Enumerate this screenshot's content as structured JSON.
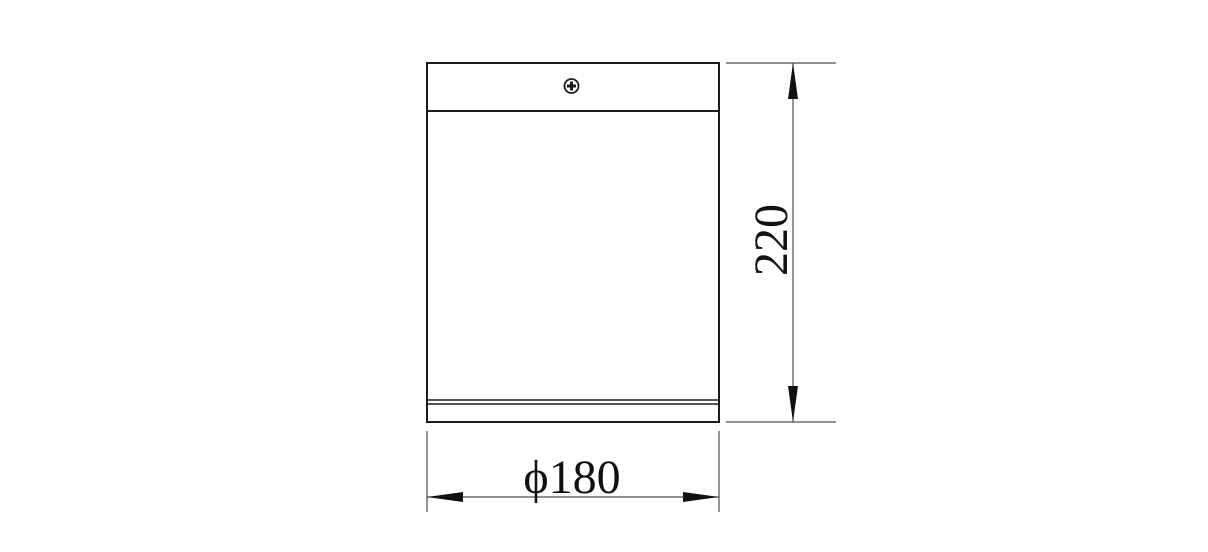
{
  "drawing": {
    "labels": {
      "diameter": "ϕ180",
      "height": "220"
    },
    "icons": {
      "screw": "phillips-screw-icon",
      "arrows": [
        "arrowhead-up-icon",
        "arrowhead-down-icon",
        "arrowhead-left-icon",
        "arrowhead-right-icon"
      ]
    },
    "colors": {
      "outline": "#1c1c1c",
      "dimension": "#4d4d4d",
      "arrow": "#111111",
      "text": "#111111",
      "background": "#ffffff"
    }
  }
}
